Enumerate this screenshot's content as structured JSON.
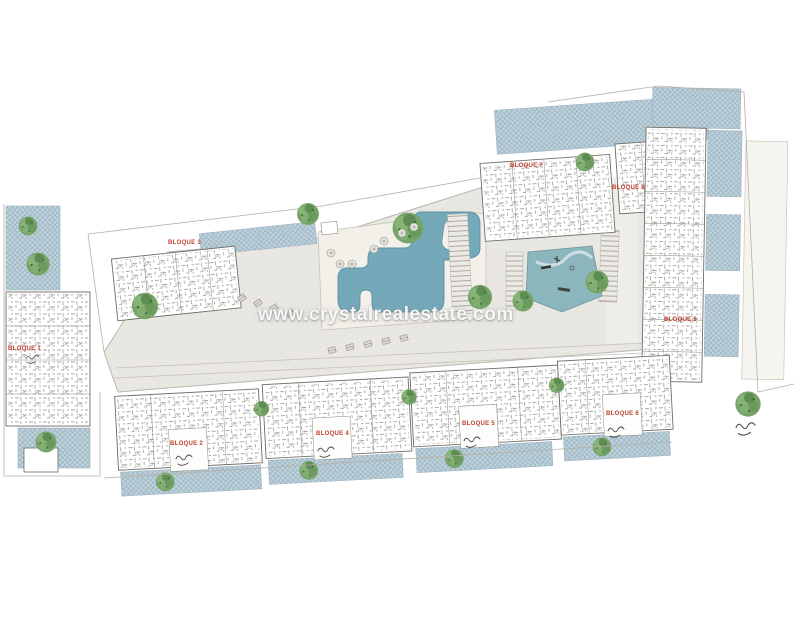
{
  "watermark": {
    "text": "www.crystalrealestate.com"
  },
  "blocks": [
    {
      "id": 1,
      "label": "BLOQUE 1"
    },
    {
      "id": 2,
      "label": "BLOQUE 2"
    },
    {
      "id": 3,
      "label": "BLOQUE 3"
    },
    {
      "id": 4,
      "label": "BLOQUE 4"
    },
    {
      "id": 5,
      "label": "BLOQUE 5"
    },
    {
      "id": 6,
      "label": "BLOQUE 6"
    },
    {
      "id": 7,
      "label": "BLOQUE 7"
    },
    {
      "id": 8,
      "label": "BLOQUE 8"
    },
    {
      "id": 9,
      "label": "BLOQUE 9"
    }
  ],
  "colors": {
    "paving": "#e9e7e1",
    "deck": "#f2f0e9",
    "terrace_blue": "#bfd2dc",
    "pool": "#74a9ba",
    "playground": "#8cb6bd",
    "tree_green": "#76a468",
    "label_red": "#c2402c",
    "outline": "#6e6c66",
    "watermark_white": "#ffffff"
  },
  "icons": {
    "tree": "tree-icon",
    "parasol": "parasol-icon",
    "parking_stall": "parking-stall-icon",
    "handwritten_mark": "handwritten-mark",
    "pool": "swimming-pool",
    "playground": "playground-area"
  }
}
